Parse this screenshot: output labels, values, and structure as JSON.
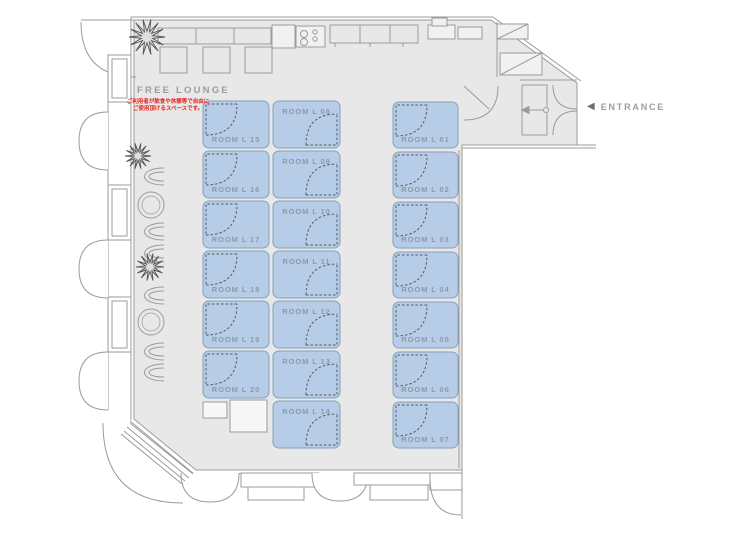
{
  "labels": {
    "free_lounge": "FREE LOUNGE",
    "free_lounge_note_line1": "ご利用者が飲食や休憩等で自由に",
    "free_lounge_note_line2": "ご使用頂けるスペースです。",
    "entrance": "ENTRANCE",
    "entrance_arrow": "◀"
  },
  "colors": {
    "outside": "#ffffff",
    "floor": "#e8e8e8",
    "wall_line": "#9b9b9b",
    "room_fill": "#b7cde7",
    "room_border": "#85a0bd",
    "room_label": "#8d9aa6",
    "door_arc": "#4d5a63",
    "label_gray": "#9d9d9d",
    "note_red": "#e3231c"
  },
  "icons": {
    "entrance_arrow": "left-triangle-icon",
    "plants": "plant-icon",
    "stove": "stove-burner-icon"
  },
  "rooms": {
    "left_column": [
      {
        "id": "room-l-15",
        "label": "ROOM L 15"
      },
      {
        "id": "room-l-16",
        "label": "ROOM L 16"
      },
      {
        "id": "room-l-17",
        "label": "ROOM L 17"
      },
      {
        "id": "room-l-18",
        "label": "ROOM L 18"
      },
      {
        "id": "room-l-19",
        "label": "ROOM L 19"
      },
      {
        "id": "room-l-20",
        "label": "ROOM L 20"
      }
    ],
    "middle_column": [
      {
        "id": "room-l-08",
        "label": "ROOM L 08"
      },
      {
        "id": "room-l-09",
        "label": "ROOM L 09"
      },
      {
        "id": "room-l-10",
        "label": "ROOM L 10"
      },
      {
        "id": "room-l-11",
        "label": "ROOM L 11"
      },
      {
        "id": "room-l-12",
        "label": "ROOM L 12"
      },
      {
        "id": "room-l-13",
        "label": "ROOM L 13"
      },
      {
        "id": "room-l-14",
        "label": "ROOM L 14"
      }
    ],
    "right_column": [
      {
        "id": "room-l-01",
        "label": "ROOM L 01"
      },
      {
        "id": "room-l-02",
        "label": "ROOM L 02"
      },
      {
        "id": "room-l-03",
        "label": "ROOM L 03"
      },
      {
        "id": "room-l-04",
        "label": "ROOM L 04"
      },
      {
        "id": "room-l-05",
        "label": "ROOM L 05"
      },
      {
        "id": "room-l-06",
        "label": "ROOM L 06"
      },
      {
        "id": "room-l-07",
        "label": "ROOM L 07"
      }
    ]
  }
}
